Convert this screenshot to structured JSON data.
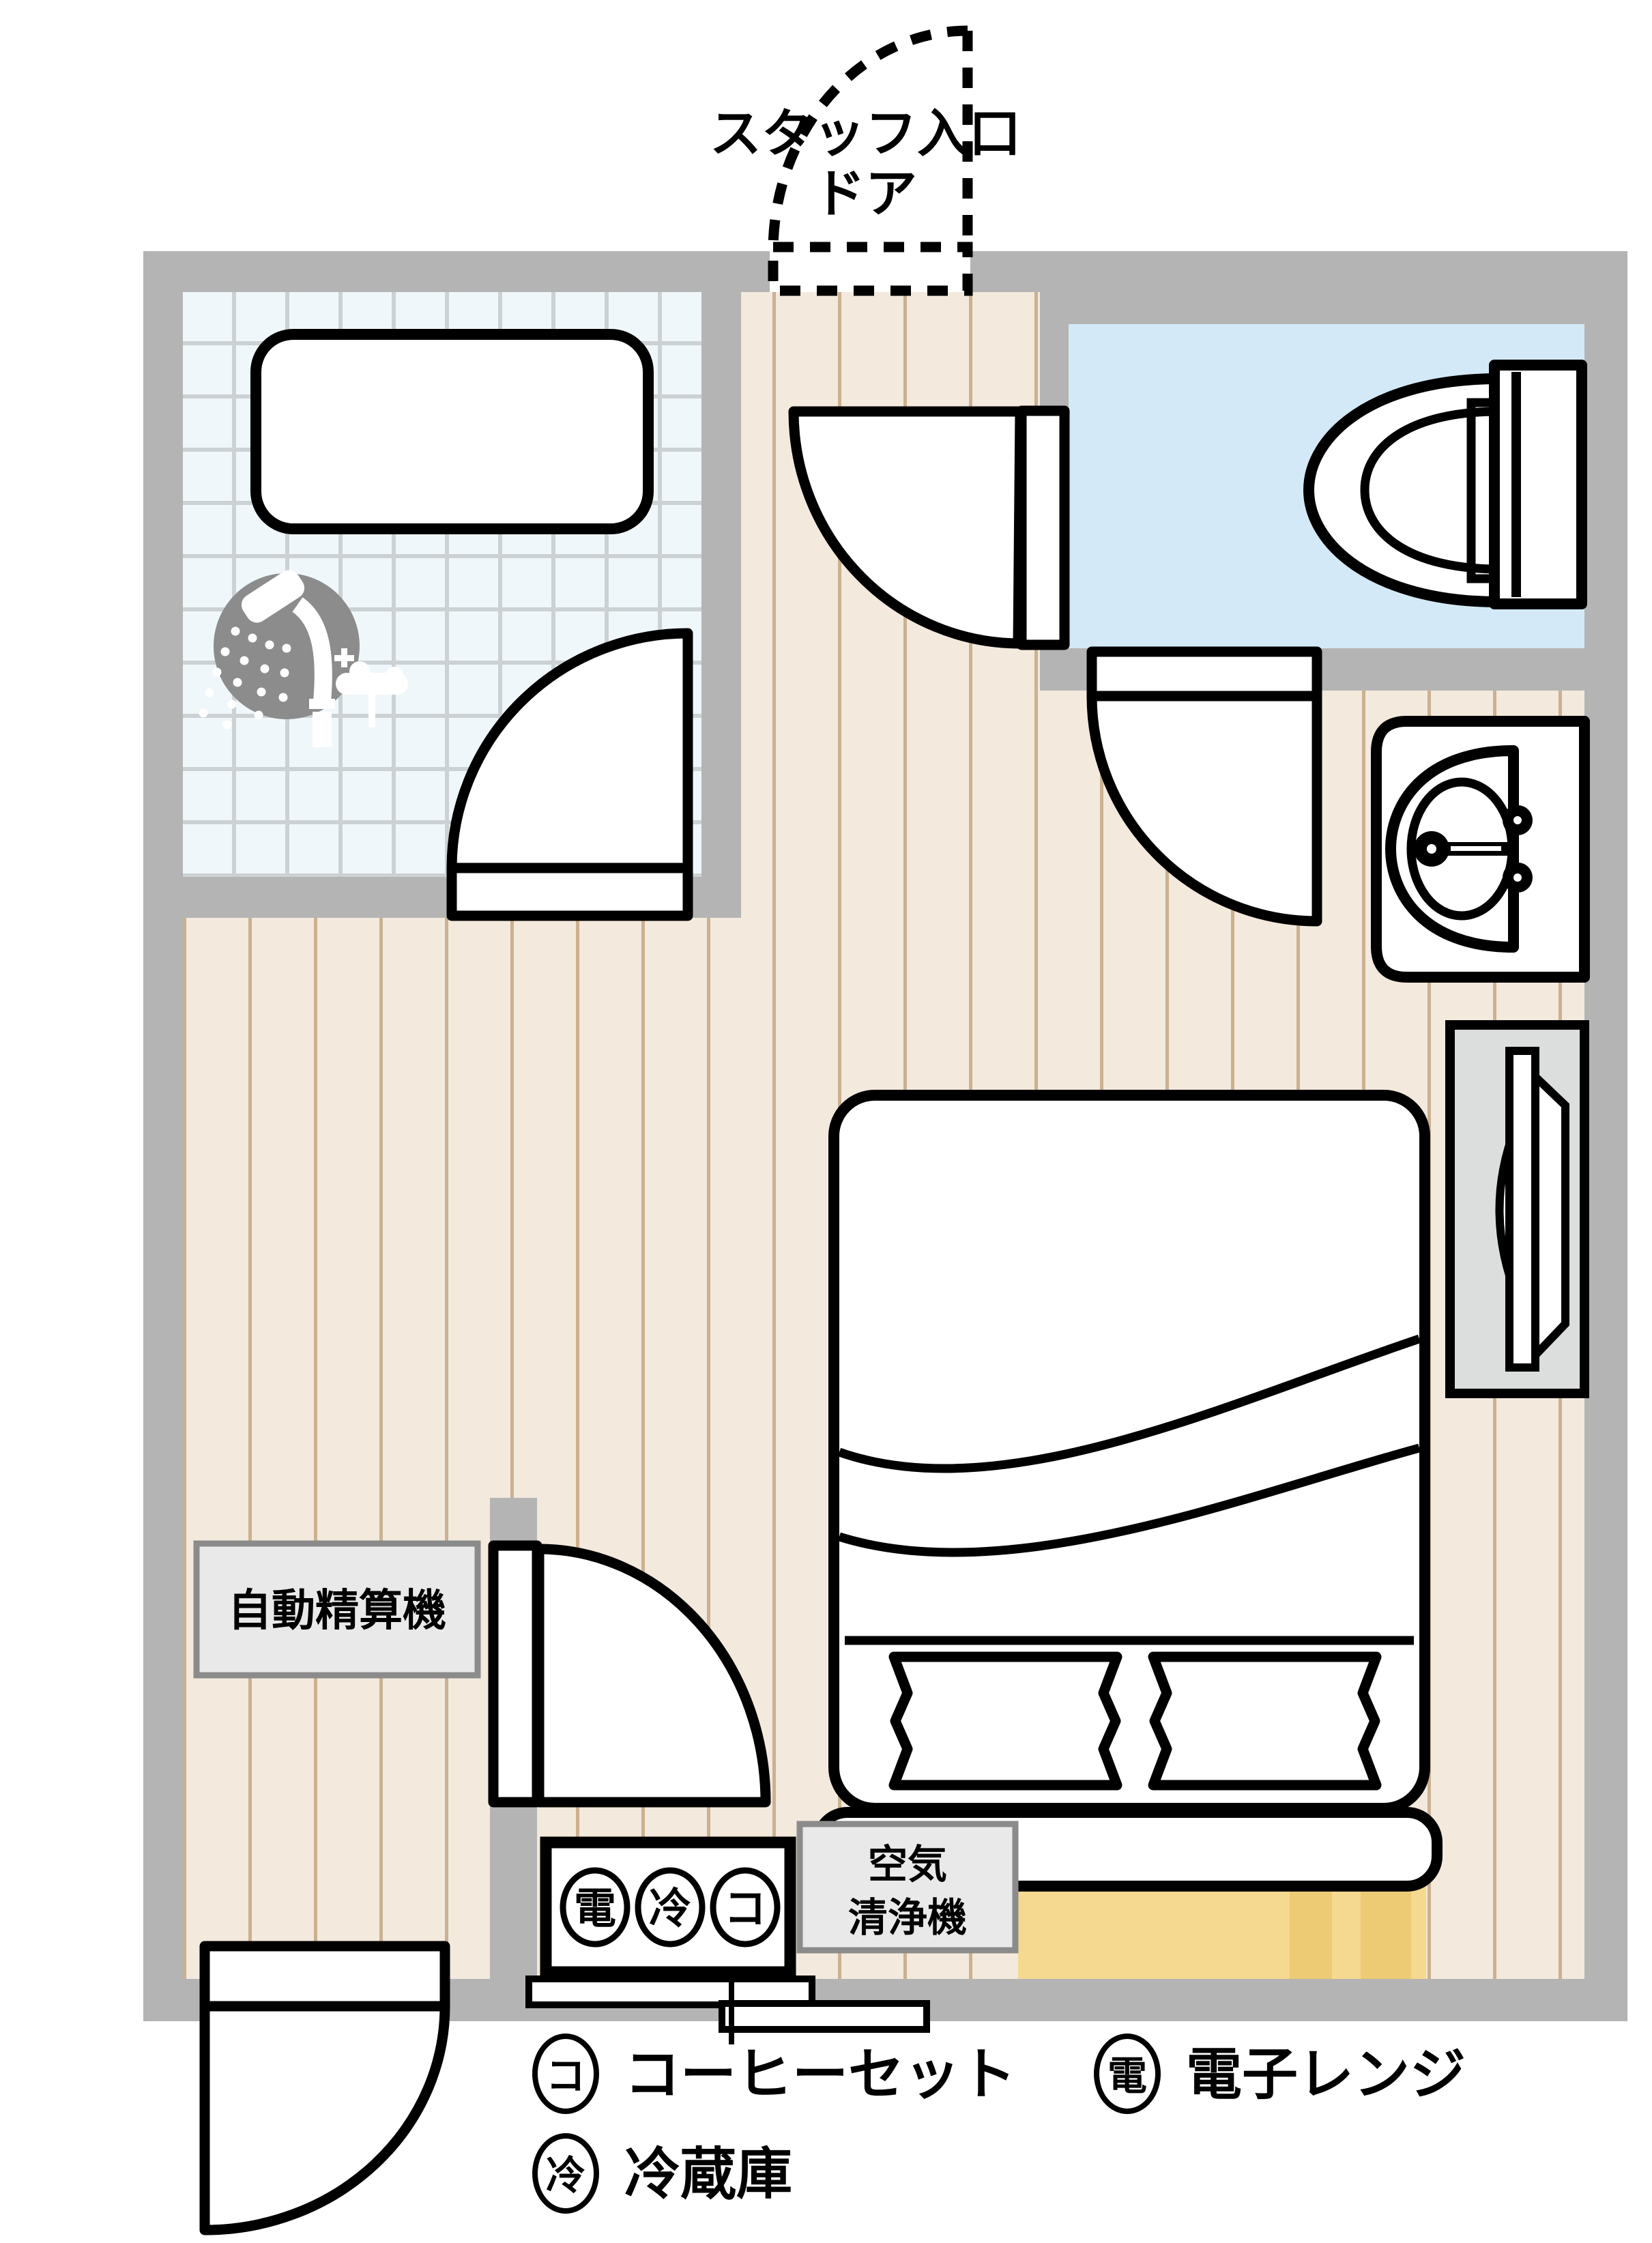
{
  "staff_door": {
    "line1": "スタッフ入口",
    "line2": "ドア"
  },
  "labels": {
    "payment_machine": "自動精算機",
    "air_purifier_line1": "空気",
    "air_purifier_line2": "清浄機"
  },
  "minibar": {
    "microwave": "電",
    "fridge": "冷",
    "coffee": "コ"
  },
  "legend": {
    "coffee_symbol": "コ",
    "coffee_label": "コーヒーセット",
    "fridge_symbol": "冷",
    "fridge_label": "冷蔵庫",
    "microwave_symbol": "電",
    "microwave_label": "電子レンジ"
  },
  "colors": {
    "wall": "#b4b4b4",
    "wood_floor": "#f3e9dd",
    "plank_line": "#cbb190",
    "tile": "#f0f7fa",
    "tile_grout": "#ccd2d4",
    "toilet_room": "#d4e9f7",
    "mat": "#f6d990",
    "mat_patch": "#eccb74",
    "tv_cabinet": "#dcdedd",
    "label_box": "#e9e9e9",
    "shower_icon": "#8c8c8c"
  }
}
